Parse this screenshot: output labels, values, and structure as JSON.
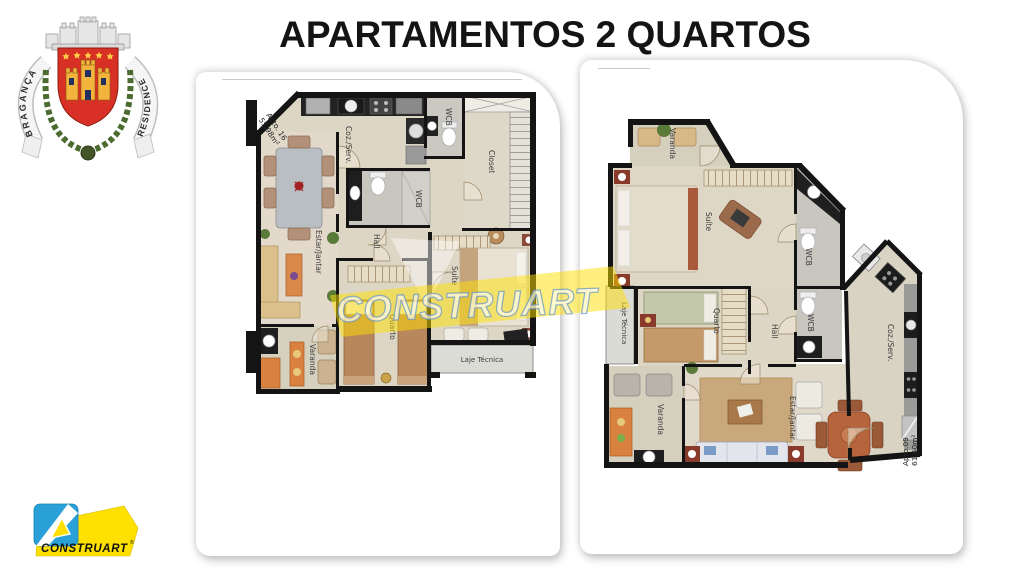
{
  "slide": {
    "title": "APARTAMENTOS 2 QUARTOS"
  },
  "crest": {
    "left_ribbon": "BRAGANÇA",
    "right_ribbon": "RESIDENCE"
  },
  "watermark": {
    "text": "CONSTRUART"
  },
  "footer_logo": {
    "text": "CONSTRUART",
    "registered_mark": "®"
  },
  "plan_left": {
    "apto": "Apto. 16",
    "area": "55,98m²",
    "rooms": {
      "coz": "Coz./Serv.",
      "wcb_top": "WCB",
      "closet": "Closet",
      "estar": "Estar/Jantar",
      "wcb_mid": "WCB",
      "hall": "Hall",
      "suite": "Suíte",
      "quarto": "Quarto",
      "varanda": "Varanda",
      "laje": "Laje Técnica"
    }
  },
  "plan_right": {
    "apto": "Apto.09",
    "area": "61,60m²",
    "rooms": {
      "varanda_top": "Varanda",
      "suite": "Suíte",
      "wcb_top": "WCB",
      "wcb_bottom": "WCB",
      "coz": "Coz./Serv.",
      "quarto": "Quarto",
      "hall": "Hall",
      "laje": "Laje Técnica",
      "varanda_bottom": "Varanda",
      "estar": "Estar/Jantar"
    }
  },
  "colors": {
    "brand_yellow": "#ffe000",
    "brand_blue": "#2aa0d8",
    "shield_red": "#d93025",
    "wall_black": "#141414",
    "floor_beige": "#ddd6c5"
  }
}
